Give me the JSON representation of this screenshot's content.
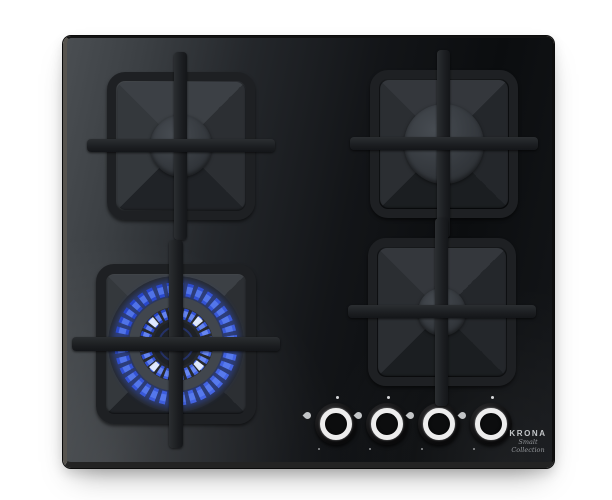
{
  "brand": {
    "name": "KRONA",
    "tagline": "Smalt Collection"
  },
  "burners": {
    "rear_left": {
      "state": "off",
      "size": "medium"
    },
    "rear_right": {
      "state": "off",
      "size": "large"
    },
    "front_left": {
      "state": "on",
      "size": "double-ring-wok",
      "flame_color": "#3a5ce0"
    },
    "front_right": {
      "state": "off",
      "size": "small"
    }
  },
  "controls": {
    "knobs": [
      {
        "id": "knob-1",
        "position": "off"
      },
      {
        "id": "knob-2",
        "position": "off"
      },
      {
        "id": "knob-3",
        "position": "off"
      },
      {
        "id": "knob-4",
        "position": "off"
      }
    ]
  },
  "colors": {
    "background": "#ffffff",
    "glass": "#131518",
    "glass_highlight": "#4a4e52",
    "grate": "#1e2023",
    "flame_blue": "#3a5ce0",
    "flame_highlight": "#dfe9ff",
    "knob_ring": "#ededed"
  }
}
